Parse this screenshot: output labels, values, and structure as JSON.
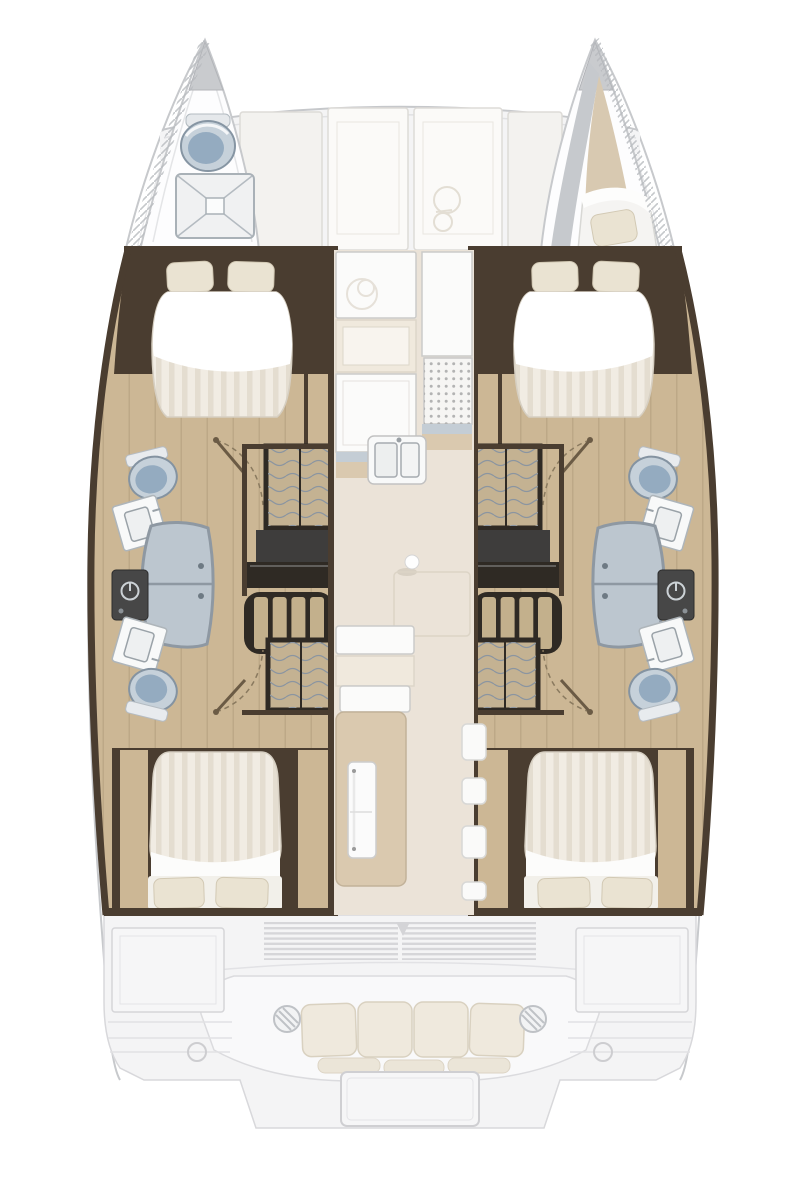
{
  "vessel": {
    "kind": "catamaran-interior-floor-plan",
    "view": "top-down",
    "hull_count": 2,
    "cabin_count": 4,
    "head_count": 4
  },
  "areas": {
    "port_bow": {
      "fixtures": [
        "toilet",
        "shower-tray"
      ]
    },
    "starboard_bow": {
      "fixtures": [
        "crew-berth",
        "pillow"
      ],
      "pillow_count": 1
    },
    "foredeck_seating": {
      "panel_count": 4,
      "glyph": "windlass"
    },
    "port_hull": {
      "forward_cabin": {
        "bed": "island-double",
        "pillow_count": 2
      },
      "forward_head": {
        "fixtures": [
          "toilet",
          "sink-vanity",
          "shower",
          "washer-unit"
        ]
      },
      "midship": {
        "fixtures": [
          "wardrobe-locker",
          "chart-desk",
          "companionway-steps",
          "wardrobe-locker"
        ]
      },
      "aft_head": {
        "fixtures": [
          "sink-vanity",
          "toilet"
        ]
      },
      "aft_cabin": {
        "bed": "double",
        "pillow_count": 2
      }
    },
    "starboard_hull": {
      "mirror_of": "port_hull"
    },
    "saloon": {
      "galley_fixtures": [
        "counter",
        "worktop",
        "stove-grate",
        "double-sink"
      ],
      "fixtures": [
        "table-leg",
        "table-outline",
        "aft-bench",
        "fridge-cabinet",
        "step-tabs"
      ],
      "step_tab_count": 4
    },
    "cockpit": {
      "louver_vent_groups": 2,
      "bench_back_cushions": 4,
      "bench_seat_cushions": 3,
      "armrest_rings": 2,
      "table_count": 1,
      "deck_hatches": 2,
      "mooring_rings": 2
    }
  },
  "colors": {
    "outline": "#c7c9cc",
    "deck": "#f4f4f5",
    "deck_line": "#d6d6d9",
    "panel": "#fbfaf8",
    "panel_shade": "#f3f2ef",
    "panel_stroke": "#dddbd7",
    "wood": "#ccb795",
    "wood_dark": "#9b8a6e",
    "wall": "#4a3d30",
    "locker": "#c4b292",
    "wave": "#8b95a0",
    "charcoal": "#3e3d3c",
    "step_frame": "#2f2a24",
    "step_wood": "#c3b08c",
    "mattress": "#f1ece3",
    "stripe": "#e4ddd0",
    "sheet": "#ffffff",
    "pillow": "#eae3d2",
    "toilet": "#94abc0",
    "toilet_light": "#c6d1da",
    "shower": "#bcc6cf",
    "shower_frame": "#8e98a2",
    "fixture_white": "#f8f9f9",
    "appliance": "#474747",
    "saloon_floor": "#ebe3d8",
    "counter": "#fbfbfa",
    "counter_stroke": "#cbcbc9",
    "counter_beige": "#f0e9dd",
    "steel": "#c4cdd5",
    "dots_bg": "#f6f5f3",
    "dot": "#b3b3b3",
    "cabinet": "#dac9af",
    "cushion": "#efe9dd",
    "cushion_stroke": "#d9d1c0",
    "bow_floor": "#d8c9b1",
    "hatch": "#b7babe"
  }
}
